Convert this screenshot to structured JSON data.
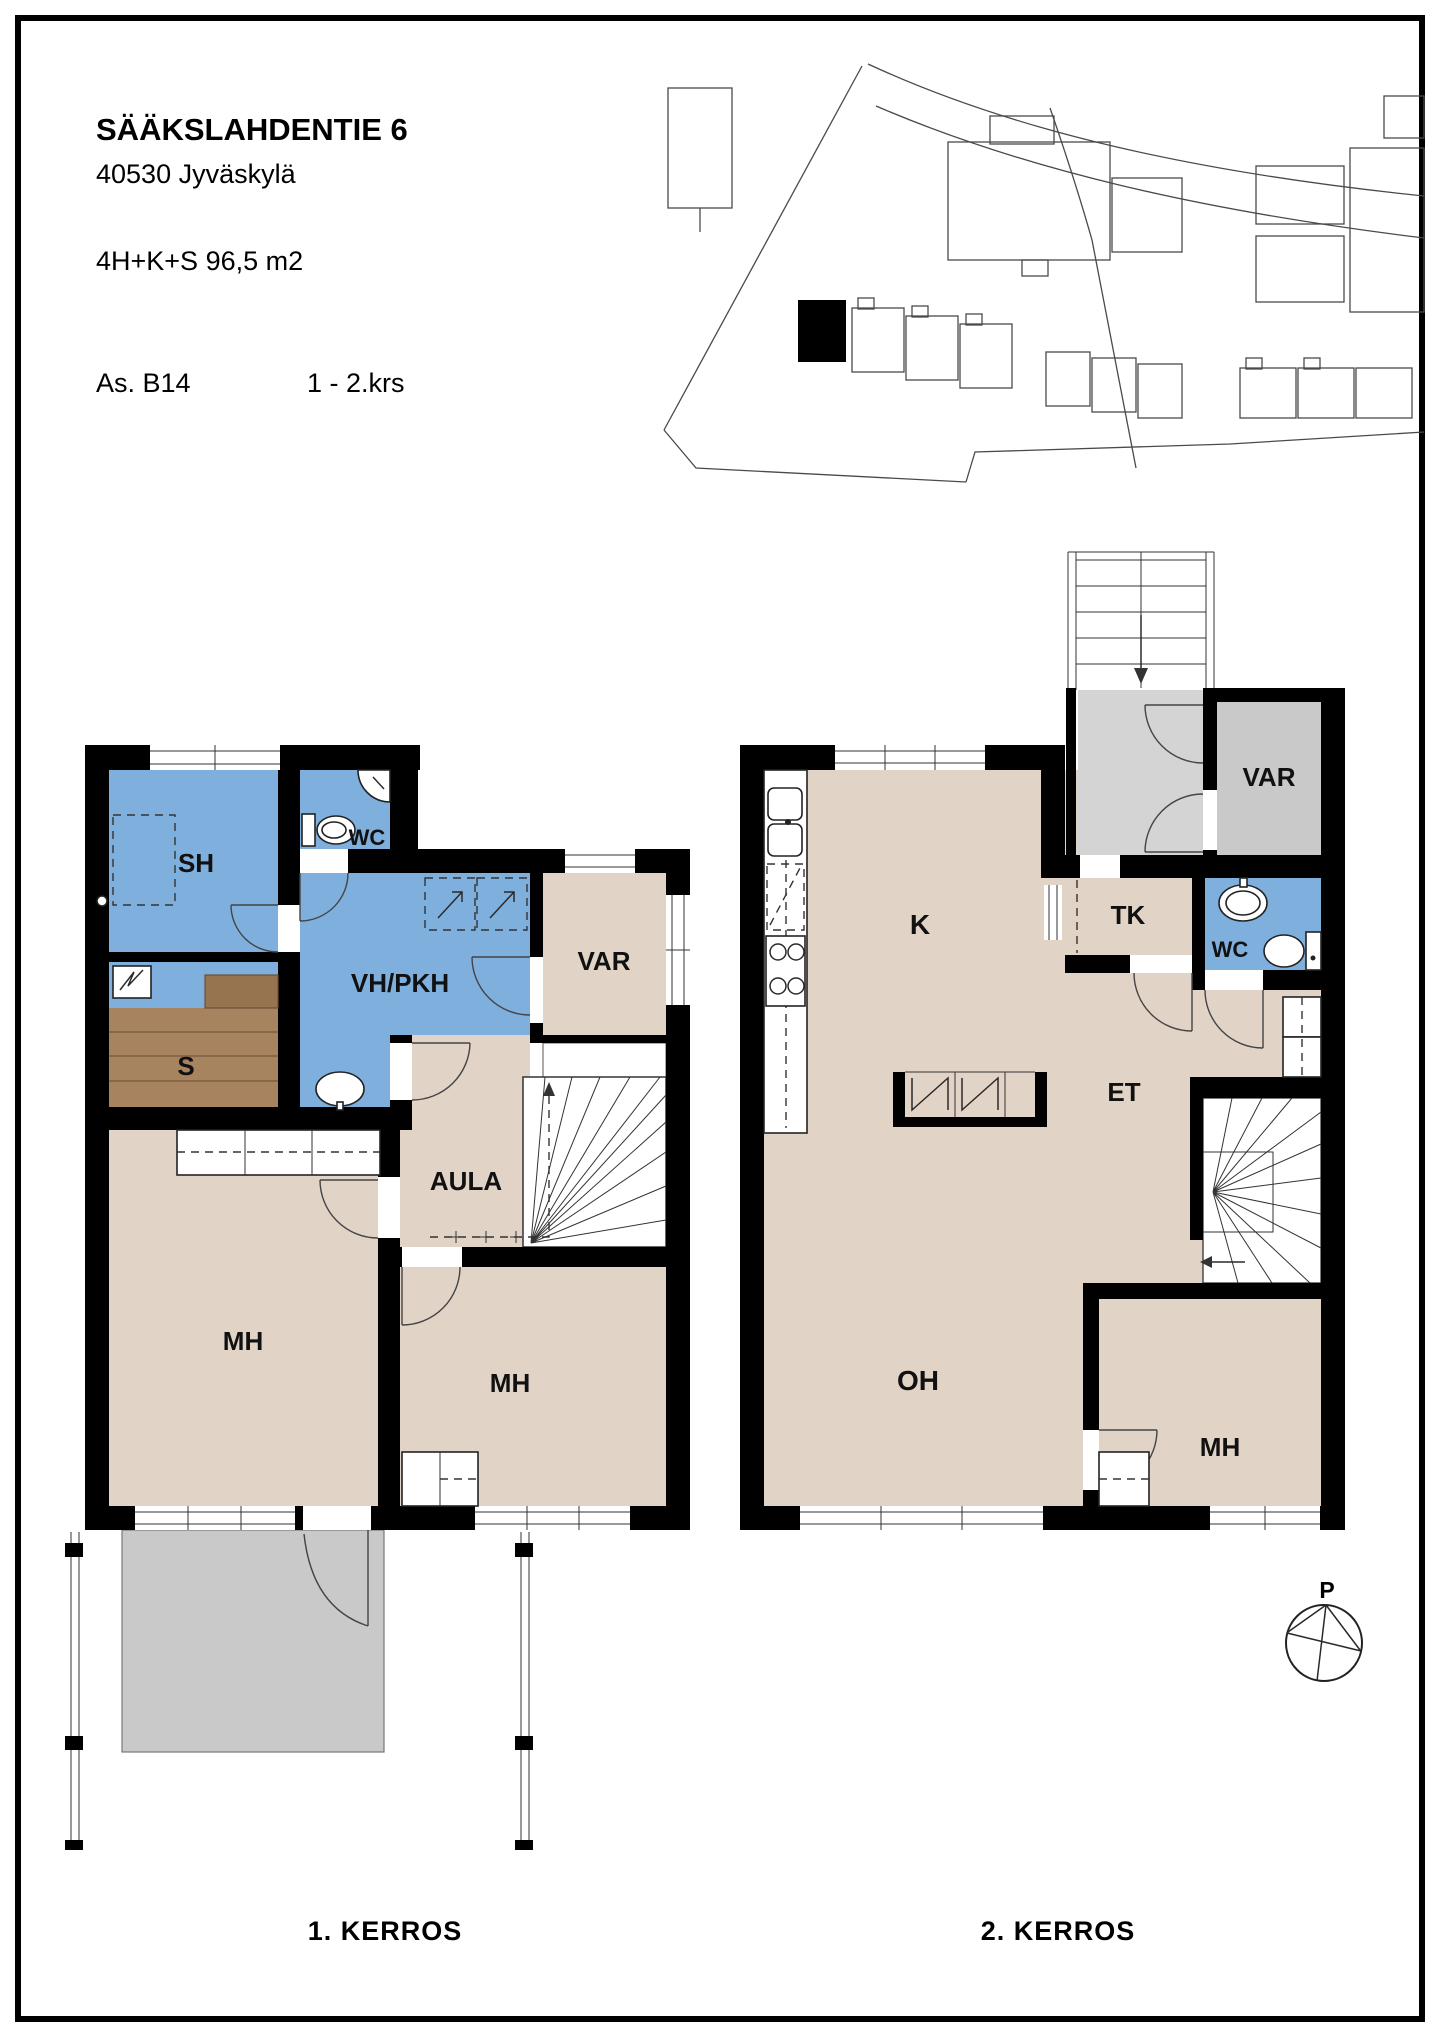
{
  "header": {
    "street_address": "SÄÄKSLAHDENTIE 6",
    "postal_city": "40530  Jyväskylä",
    "apartment_summary": "4H+K+S  96,5 m2",
    "apartment_id": "As. B14",
    "floor_range": "1 - 2.krs"
  },
  "floor1": {
    "caption": "1. KERROS",
    "rooms": {
      "sh": "SH",
      "wc": "WC",
      "vh_pkh": "VH/PKH",
      "var": "VAR",
      "sauna": "S",
      "aula": "AULA",
      "mh_left": "MH",
      "mh_right": "MH"
    }
  },
  "floor2": {
    "caption": "2. KERROS",
    "rooms": {
      "k": "K",
      "tk": "TK",
      "wc": "WC",
      "var": "VAR",
      "et": "ET",
      "oh": "OH",
      "mh": "MH"
    }
  },
  "compass": {
    "north_label": "P"
  },
  "colors": {
    "wet_area_blue": "#7fb0dd",
    "room_beige": "#e2d3c7",
    "sauna_brown": "#a8835f",
    "sauna_bench_brown": "#96744f",
    "outdoor_gray": "#c9c9c9",
    "landing_gray": "#d4d4d4",
    "wall_black": "#000000"
  }
}
